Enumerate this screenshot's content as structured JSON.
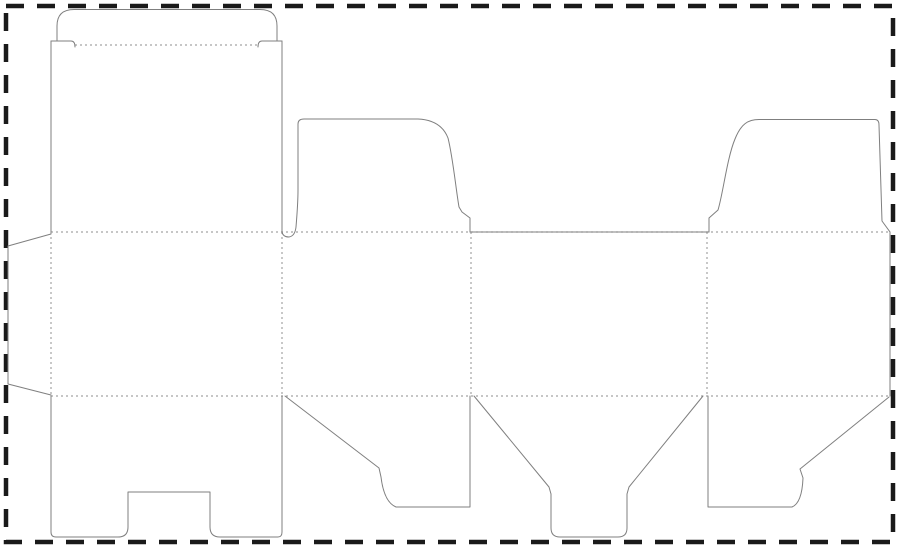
{
  "canvas": {
    "width": 900,
    "height": 548,
    "background": "#ffffff"
  },
  "colors": {
    "cut_line": "#7f7f7f",
    "fold_line": "#a3a3a3",
    "sheet_border": "#1a1a1a"
  },
  "sheet_border": {
    "x": 6,
    "y": 6,
    "width": 887,
    "height": 536,
    "stroke_width": 4.5,
    "dash_pattern": "18 13"
  },
  "dieline": {
    "description": "snap-lock-bottom tuck-top carton die-cut template",
    "fold_lines": [
      {
        "name": "fold-top-horizontal",
        "d": "M51,232 L890,232"
      },
      {
        "name": "fold-bottom-horizontal",
        "d": "M51,396 L890,396"
      },
      {
        "name": "fold-vertical-glue",
        "d": "M51,232 L51,396"
      },
      {
        "name": "fold-vertical-panel1-2",
        "d": "M282,232 L282,396"
      },
      {
        "name": "fold-vertical-panel2-3",
        "d": "M471,232 L471,396"
      },
      {
        "name": "fold-vertical-panel3-4",
        "d": "M707,232 L707,396"
      },
      {
        "name": "fold-tuck-flap-crease",
        "d": "M75,45 L258,45"
      }
    ],
    "cut_paths": [
      {
        "name": "glue-flap-outline",
        "d": "M51,234 L8,246 L8,384 L51,395"
      },
      {
        "name": "front-panel-left-edge",
        "d": "M51,41 L51,232"
      },
      {
        "name": "front-panel-right-edge",
        "d": "M282,41 L282,232"
      },
      {
        "name": "tuck-shoulder-left",
        "d": "M51,41 L71,41 Q75,41 75,47"
      },
      {
        "name": "tuck-shoulder-right",
        "d": "M282,41 L262,41 Q258,41 258,47"
      },
      {
        "name": "tuck-flap-outline",
        "d": "M57,41 L57,26 Q57,9.5 74,9.5 L260,9.5 Q277,9.5 277,26 L277,41"
      },
      {
        "name": "dust-flap-left-outline",
        "d": "M282,232 Q283,237 289,237 Q295,236 296,227 C297,215 298,203 298,190 L298,124 Q298,119 304,119 L418,119 Q441,120 448,138 C453,158 456,190 459,207 L462,212 L470,218 L470,232"
      },
      {
        "name": "back-panel-top-edge",
        "d": "M470,232 L709,232"
      },
      {
        "name": "dust-flap-right-outline",
        "d": "M709,232 L709,218 L718,210 C723,194 727,158 735,139 C741,124 748,119.5 759,119.5 L875,119.5 Q879,119.5 879,125 L882,221 L890,232"
      },
      {
        "name": "sheet-right-edge",
        "d": "M890,232 L890,396"
      },
      {
        "name": "lock-bottom-flap-outline",
        "d": "M51,396 L51,532 Q51,537 56,537 L118,537 Q128,537 128,527 L128,492 L210,492 L210,527 Q210,537 220,537 L278,537 Q282,537 282,532 L282,396"
      },
      {
        "name": "bottom-flap-side1-outline",
        "d": "M285,396 L379,468 L381,477 Q384,502 396,507 L470,507 L470,396"
      },
      {
        "name": "bottom-funnel-flap-outline",
        "d": "M474,396 L549,487 L551,494 L551,528 Q551,537 560,537 L618,537 Q627,537 627,528 L627,494 L629,487 L703,396"
      },
      {
        "name": "bottom-flap-side2-outline",
        "d": "M708,396 L708,507 L792,507 Q802,503 803,478 L800,469 L889,397"
      }
    ]
  }
}
